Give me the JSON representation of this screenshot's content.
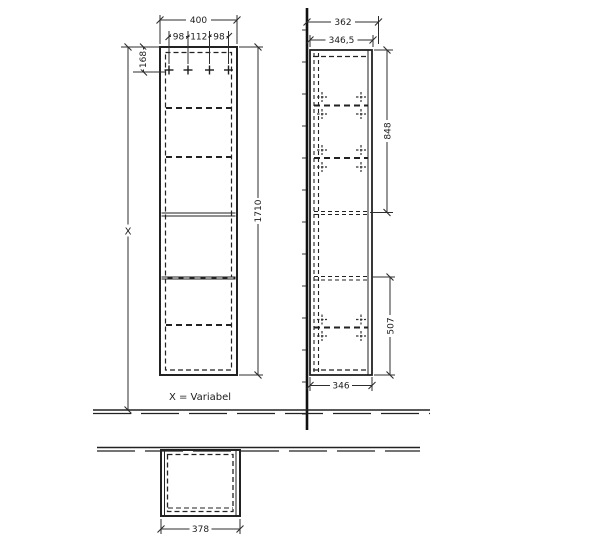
{
  "front_view": {
    "width_total": "400",
    "hole_spacing_left": "98",
    "hole_spacing_center": "112",
    "hole_spacing_right": "98",
    "top_hole_offset": "168",
    "height_total": "1710",
    "height_variable": "X",
    "variable_note": "X = Variabel"
  },
  "side_view": {
    "depth_from_wall": "362",
    "depth_top": "346,5",
    "hole_span_upper": "848",
    "hole_span_lower": "507",
    "depth_bottom": "346"
  },
  "plan_view": {
    "width": "378"
  },
  "colors": {
    "line": "#2d2d2d",
    "background": "#ffffff"
  }
}
